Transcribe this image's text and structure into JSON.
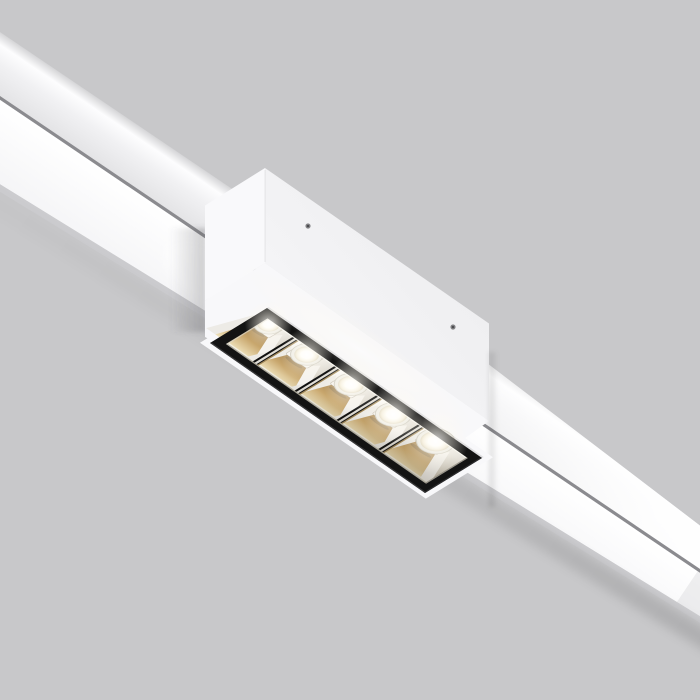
{
  "scene": {
    "type": "product-photo",
    "subject": "white magnetic track linear LED spotlight with 5 square lenses, mounted on a slim white track, viewed from below at a diagonal angle",
    "background_color": "#c8c8ca"
  },
  "track": {
    "angle_deg": 34,
    "diffuser_color": "#fdfdfe",
    "facet_color": "#e9e9eb",
    "groove_color": "#85858a",
    "lip_color": "#cdcdd0"
  },
  "fixture": {
    "body_color": "#f2f2f4",
    "body_bright_color": "#f9f9fb",
    "screws": [
      {
        "x": 308,
        "y": 226
      },
      {
        "x": 453,
        "y": 327
      }
    ]
  },
  "module": {
    "frame_color": "#131313",
    "gold_color": "#c7a468",
    "lens_color": "#ffffff",
    "cell_count": 5,
    "transform": [
      0.8206,
      0.5725,
      -0.8507,
      0.5224,
      267,
      308
    ],
    "cell_bounds": [
      [
        10,
        45
      ],
      [
        45,
        96
      ],
      [
        96,
        147
      ],
      [
        147,
        198
      ],
      [
        198,
        254
      ]
    ],
    "dividers_u": [
      45,
      96,
      147,
      198
    ],
    "cells": [
      {
        "u": 16,
        "v": 13.5,
        "r": 9.5
      },
      {
        "u": 66,
        "v": 17,
        "r": 10.5
      },
      {
        "u": 119,
        "v": 16,
        "r": 11
      },
      {
        "u": 171,
        "v": 16.5,
        "r": 12
      },
      {
        "u": 220,
        "v": 14,
        "r": 13
      }
    ]
  }
}
